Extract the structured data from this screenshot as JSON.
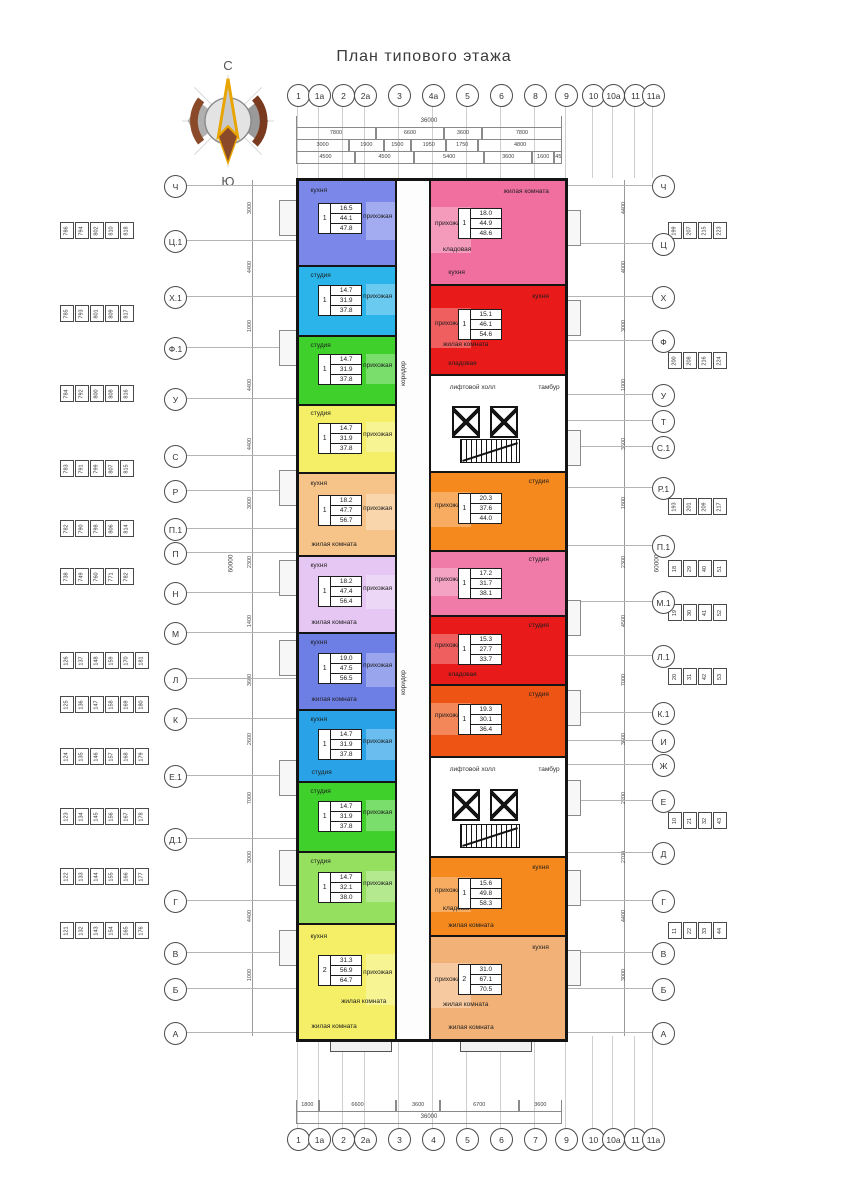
{
  "title": "План типового этажа",
  "compass": {
    "north": "С",
    "south": "Ю"
  },
  "axes": {
    "top": [
      "1",
      "1а",
      "2",
      "2а",
      "3",
      "4а",
      "5",
      "6",
      "8",
      "9",
      "10",
      "10а",
      "11",
      "11а"
    ],
    "bottom": [
      "1",
      "1а",
      "2",
      "2а",
      "3",
      "4",
      "5",
      "6",
      "7",
      "9",
      "10",
      "10а",
      "11",
      "11а"
    ],
    "left": [
      "Ч",
      "Ц.1",
      "Х.1",
      "Ф.1",
      "У",
      "С",
      "Р",
      "П.1",
      "П",
      "Н",
      "М",
      "Л",
      "К",
      "Е.1",
      "Д.1",
      "Г",
      "В",
      "Б",
      "А"
    ],
    "right": [
      "Ч",
      "Ц",
      "Х",
      "Ф",
      "У",
      "Т",
      "С.1",
      "Р.1",
      "П.1",
      "М.1",
      "Л.1",
      "К.1",
      "И",
      "Ж",
      "Е",
      "Д",
      "Г",
      "В",
      "Б",
      "А"
    ]
  },
  "dimensions": {
    "top": {
      "overall": "36000",
      "rows": [
        [
          "7800",
          "6600",
          "3600",
          "7800"
        ],
        [
          "3000",
          "1900",
          "1500",
          "1950",
          "1750",
          "4800"
        ],
        [
          "4500",
          "4500",
          "5400",
          "3600",
          "1600",
          "450"
        ]
      ]
    },
    "bottom": {
      "overall": "36000",
      "rows": [
        [
          "1800",
          "6600",
          "3600",
          "6700",
          "3600"
        ]
      ]
    },
    "left": {
      "overall": "60000",
      "segments": [
        "3000",
        "4400",
        "1000",
        "4400",
        "4400",
        "3000",
        "2300",
        "1400",
        "3600",
        "2600",
        "7000",
        "3000",
        "4400",
        "1000"
      ]
    },
    "right": {
      "overall": "60000",
      "segments": [
        "4400",
        "4000",
        "3000",
        "1000",
        "3600",
        "1800",
        "2300",
        "4500",
        "7000",
        "3600",
        "2200",
        "2700",
        "4400",
        "3000"
      ]
    }
  },
  "unit_number_strips": {
    "left": [
      [
        "786",
        "794",
        "802",
        "810",
        "818"
      ],
      [
        "785",
        "793",
        "801",
        "809",
        "817"
      ],
      [
        "784",
        "792",
        "800",
        "808",
        "816"
      ],
      [
        "783",
        "791",
        "799",
        "807",
        "815"
      ],
      [
        "782",
        "790",
        "798",
        "806",
        "814"
      ],
      [
        "738",
        "749",
        "760",
        "771",
        "782"
      ],
      [
        "126",
        "137",
        "148",
        "159",
        "170",
        "181"
      ],
      [
        "125",
        "136",
        "147",
        "158",
        "169",
        "180"
      ],
      [
        "124",
        "135",
        "146",
        "157",
        "168",
        "179"
      ],
      [
        "123",
        "134",
        "145",
        "156",
        "167",
        "178"
      ],
      [
        "122",
        "133",
        "144",
        "155",
        "166",
        "177"
      ],
      [
        "121",
        "132",
        "143",
        "154",
        "165",
        "176"
      ]
    ],
    "right": [
      [
        "199",
        "207",
        "215",
        "223"
      ],
      [
        "200",
        "208",
        "216",
        "224"
      ],
      [
        "193",
        "201",
        "209",
        "217"
      ],
      [
        "18",
        "29",
        "40",
        "51"
      ],
      [
        "19",
        "30",
        "41",
        "52"
      ],
      [
        "20",
        "31",
        "42",
        "53"
      ],
      [
        "10",
        "21",
        "32",
        "43"
      ],
      [
        "11",
        "22",
        "33",
        "44"
      ]
    ]
  },
  "plan": {
    "corridor_label": "коридор",
    "core_labels": {
      "hall": "лифтовой холл",
      "vestibule": "тамбур"
    },
    "left_column": [
      {
        "color": "#7b88ea",
        "flex": 96,
        "rooms": [
          "кухня",
          "прихожая"
        ],
        "badge": {
          "count": "1",
          "kitchen": "16.5",
          "living": "44.1",
          "total": "47.8"
        }
      },
      {
        "color": "#2ab4ea",
        "flex": 78,
        "rooms": [
          "студия",
          "прихожая"
        ],
        "badge": {
          "count": "1",
          "kitchen": "14.7",
          "living": "31.9",
          "total": "37.8"
        }
      },
      {
        "color": "#3fd02c",
        "flex": 76,
        "rooms": [
          "студия",
          "прихожая"
        ],
        "badge": {
          "count": "1",
          "kitchen": "14.7",
          "living": "31.9",
          "total": "37.8"
        }
      },
      {
        "color": "#f4ef66",
        "flex": 76,
        "rooms": [
          "студия",
          "прихожая"
        ],
        "badge": {
          "count": "1",
          "kitchen": "14.7",
          "living": "31.9",
          "total": "37.8"
        }
      },
      {
        "color": "#f6c488",
        "flex": 92,
        "rooms": [
          "кухня",
          "прихожая",
          "жилая комната"
        ],
        "badge": {
          "count": "1",
          "kitchen": "18.2",
          "living": "47.7",
          "total": "56.7"
        }
      },
      {
        "color": "#e6c6f2",
        "flex": 86,
        "rooms": [
          "кухня",
          "прихожая",
          "жилая комната"
        ],
        "badge": {
          "count": "1",
          "kitchen": "18.2",
          "living": "47.4",
          "total": "56.4"
        }
      },
      {
        "color": "#6d7ee4",
        "flex": 86,
        "rooms": [
          "кухня",
          "прихожая",
          "жилая комната"
        ],
        "badge": {
          "count": "1",
          "kitchen": "19.0",
          "living": "47.5",
          "total": "56.5"
        }
      },
      {
        "color": "#2aa2e8",
        "flex": 80,
        "rooms": [
          "кухня",
          "прихожая",
          "студия"
        ],
        "badge": {
          "count": "1",
          "kitchen": "14.7",
          "living": "31.9",
          "total": "37.8"
        }
      },
      {
        "color": "#3fd02c",
        "flex": 78,
        "rooms": [
          "студия",
          "прихожая"
        ],
        "badge": {
          "count": "1",
          "kitchen": "14.7",
          "living": "31.9",
          "total": "37.8"
        }
      },
      {
        "color": "#96e060",
        "flex": 80,
        "rooms": [
          "студия",
          "прихожая"
        ],
        "badge": {
          "count": "1",
          "kitchen": "14.7",
          "living": "32.1",
          "total": "38.0"
        }
      },
      {
        "color": "#f4ef66",
        "flex": 130,
        "rooms": [
          "кухня",
          "прихожая",
          "жилая комната",
          "жилая комната"
        ],
        "badge": {
          "count": "2",
          "kitchen": "31.3",
          "living": "56.9",
          "total": "64.7"
        }
      }
    ],
    "right_column": [
      {
        "kind": "apt",
        "color": "#f06f9e",
        "flex": 118,
        "rooms": [
          "жилая комната",
          "прихожая",
          "кухня",
          "кладовая"
        ],
        "badge": {
          "count": "1",
          "kitchen": "18.0",
          "living": "44.9",
          "total": "48.6"
        }
      },
      {
        "kind": "apt",
        "color": "#e81a1a",
        "flex": 100,
        "rooms": [
          "кухня",
          "прихожая",
          "кладовая",
          "жилая комната"
        ],
        "badge": {
          "count": "1",
          "kitchen": "15.1",
          "living": "46.1",
          "total": "54.6"
        }
      },
      {
        "kind": "core",
        "flex": 108
      },
      {
        "kind": "apt",
        "color": "#f5891d",
        "flex": 88,
        "rooms": [
          "студия",
          "прихожая"
        ],
        "badge": {
          "count": "1",
          "kitchen": "20.3",
          "living": "37.6",
          "total": "44.0"
        }
      },
      {
        "kind": "apt",
        "color": "#f07ba8",
        "flex": 72,
        "rooms": [
          "студия",
          "прихожая"
        ],
        "badge": {
          "count": "1",
          "kitchen": "17.2",
          "living": "31.7",
          "total": "38.1"
        }
      },
      {
        "kind": "apt",
        "color": "#e81a1a",
        "flex": 76,
        "rooms": [
          "студия",
          "прихожая",
          "кладовая"
        ],
        "badge": {
          "count": "1",
          "kitchen": "15.3",
          "living": "27.7",
          "total": "33.7"
        }
      },
      {
        "kind": "apt",
        "color": "#ee5413",
        "flex": 80,
        "rooms": [
          "студия",
          "прихожая"
        ],
        "badge": {
          "count": "1",
          "kitchen": "19.3",
          "living": "30.1",
          "total": "36.4"
        }
      },
      {
        "kind": "core",
        "flex": 112
      },
      {
        "kind": "apt",
        "color": "#f5891d",
        "flex": 88,
        "rooms": [
          "кухня",
          "прихожая",
          "жилая комната",
          "кладовая"
        ],
        "badge": {
          "count": "1",
          "kitchen": "15.6",
          "living": "49.8",
          "total": "58.3"
        }
      },
      {
        "kind": "apt",
        "color": "#f2b277",
        "flex": 116,
        "rooms": [
          "кухня",
          "прихожая",
          "жилая комната",
          "жилая комната"
        ],
        "badge": {
          "count": "2",
          "kitchen": "31.0",
          "living": "67.1",
          "total": "70.5"
        }
      }
    ]
  }
}
